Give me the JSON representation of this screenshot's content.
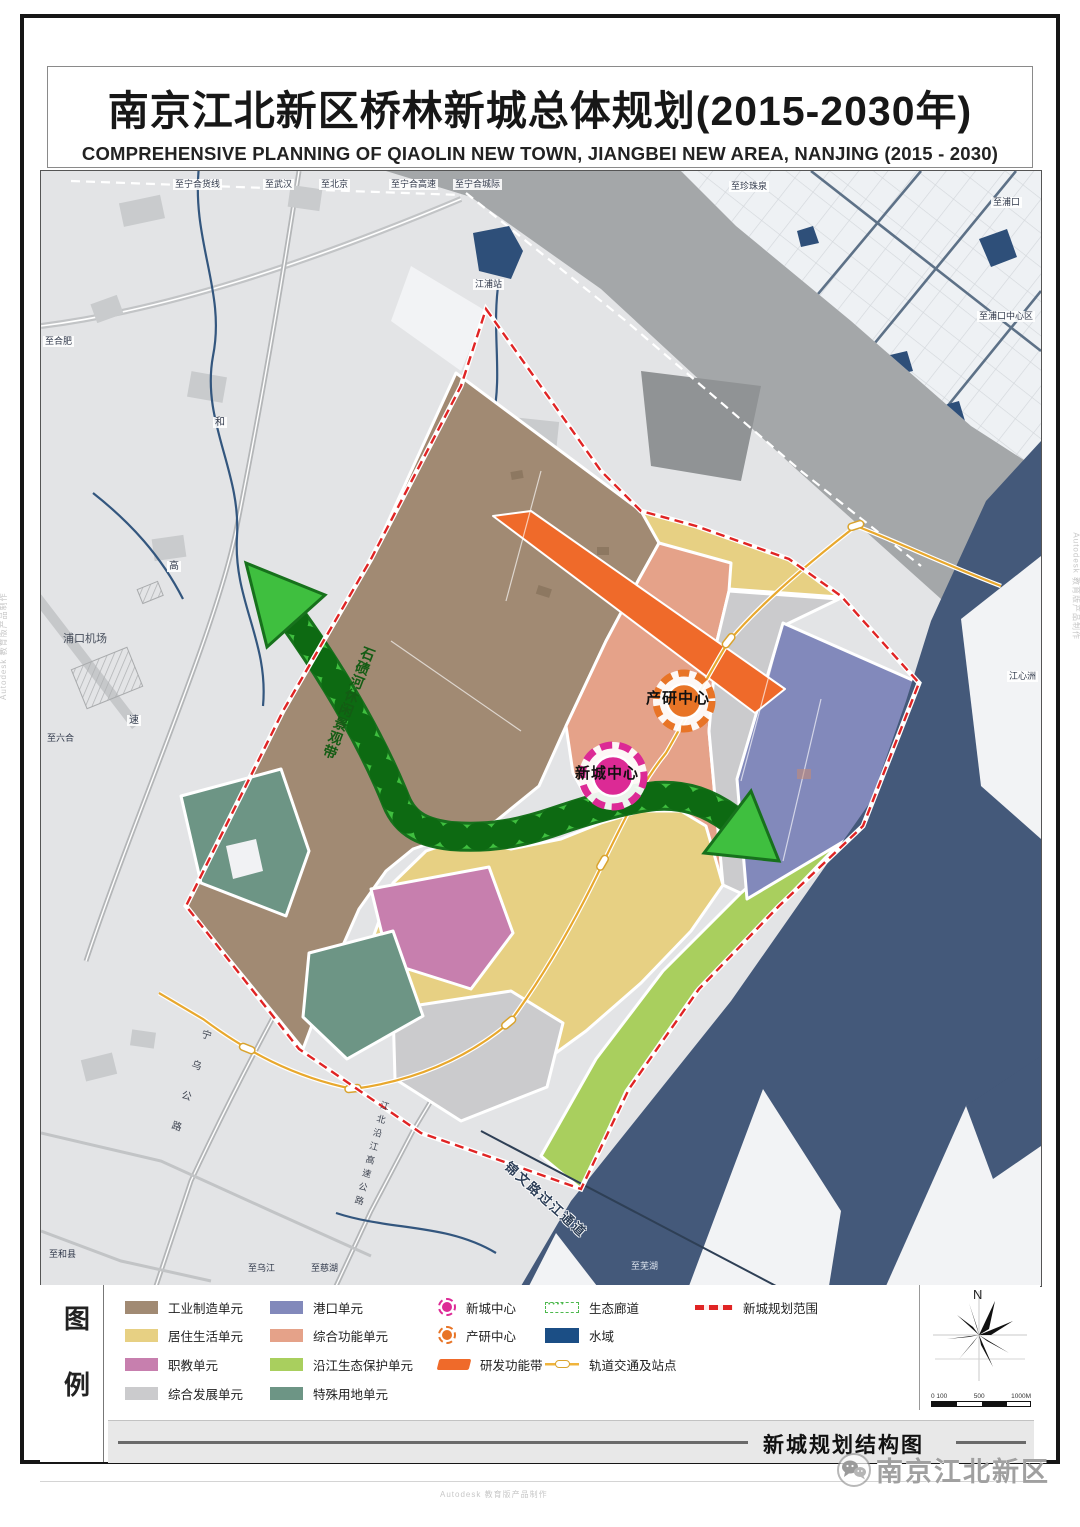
{
  "title": {
    "zh": "南京江北新区桥林新城总体规划(2015-2030年)",
    "en": "COMPREHENSIVE PLANNING OF QIAOLIN NEW TOWN, JIANGBEI NEW AREA, NANJING (2015 - 2030)"
  },
  "watermark": {
    "autodesk": "Autodesk 教育版产品制作"
  },
  "map": {
    "labels": {
      "ninghe_freight": "至宁合货线",
      "wuhan": "至武汉",
      "beijing": "至北京",
      "ninghe_expwy": "至宁合高速",
      "ninghe_intercity": "至宁合城际",
      "zhenzhuquan": "至珍珠泉",
      "pukou": "至浦口",
      "jiangpu_station": "江浦站",
      "pukou_center": "至浦口中心区",
      "hefei": "至合肥",
      "jiangxinzhou": "江心洲",
      "pukou_airport": "浦口机场",
      "liuhe": "至六合",
      "hexian": "至和县",
      "wujiang": "至乌江",
      "cihu": "至慈湖",
      "wuhu": "至芜湖",
      "chanyan_center": "产研中心",
      "xincheng_center": "新城中心",
      "corridor": "石碛河休闲景观带",
      "jinwen_crossing": "锦文路过江通道",
      "ningwu_road": "宁乌公路",
      "yanjiang_expwy": "江北沿江高速公路",
      "gao": "高",
      "su": "速",
      "he": "和"
    }
  },
  "legend": {
    "title": "图例",
    "title_chars": [
      "图",
      "例"
    ],
    "items": [
      {
        "label": "工业制造单元",
        "color": "#a18a73",
        "kind": "swatch"
      },
      {
        "label": "居住生活单元",
        "color": "#e7d083",
        "kind": "swatch"
      },
      {
        "label": "职教单元",
        "color": "#c77fae",
        "kind": "swatch"
      },
      {
        "label": "综合发展单元",
        "color": "#cbcbcd",
        "kind": "swatch"
      },
      {
        "label": "港口单元",
        "color": "#8289bb",
        "kind": "swatch"
      },
      {
        "label": "综合功能单元",
        "color": "#e5a289",
        "kind": "swatch"
      },
      {
        "label": "沿江生态保护单元",
        "color": "#a9cf5e",
        "kind": "swatch"
      },
      {
        "label": "特殊用地单元",
        "color": "#6d9585",
        "kind": "swatch"
      },
      {
        "label": "新城中心",
        "color": "#dd2a96",
        "kind": "center-circle"
      },
      {
        "label": "产研中心",
        "color": "#e87426",
        "kind": "center-circle"
      },
      {
        "label": "研发功能带",
        "color": "#ef6a2a",
        "kind": "band"
      },
      {
        "label": "生态廊道",
        "color": "#4db84d",
        "kind": "eco"
      },
      {
        "label": "水域",
        "color": "#1b4e85",
        "kind": "swatch"
      },
      {
        "label": "轨道交通及站点",
        "color": "#f0b43c",
        "kind": "rail"
      },
      {
        "label": "新城规划范围",
        "color": "#e02424",
        "kind": "boundary"
      }
    ]
  },
  "compass": {
    "north": "N",
    "scale": [
      "0 100",
      "500",
      "1000M"
    ]
  },
  "footer": {
    "drawing_title": "新城规划结构图"
  },
  "branding": {
    "account": "南京江北新区"
  }
}
